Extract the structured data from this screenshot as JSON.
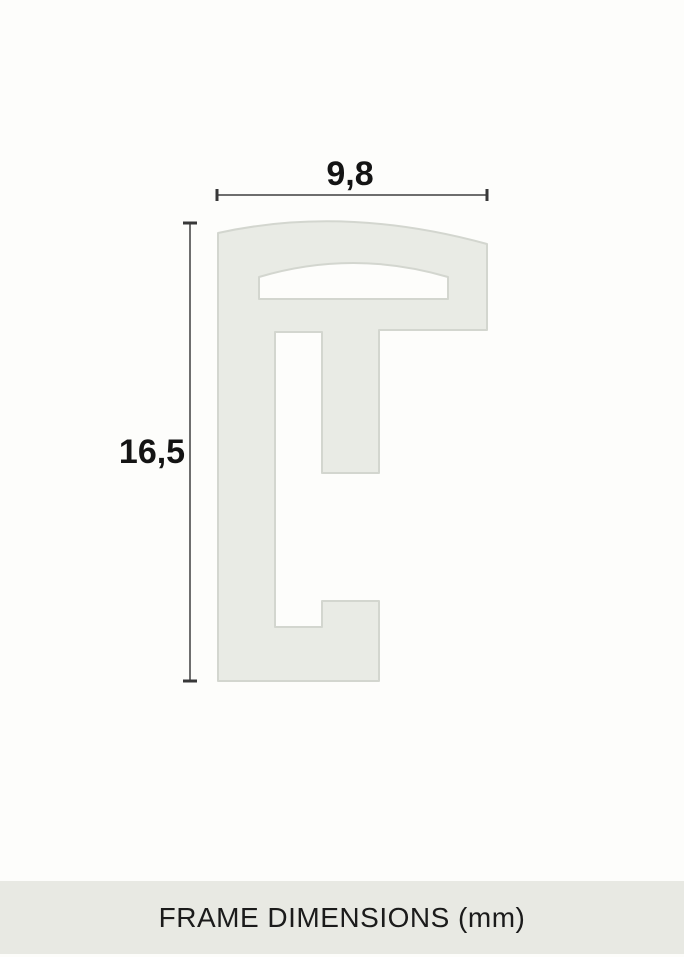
{
  "diagram": {
    "width_label": "9,8",
    "height_label": "16,5",
    "profile": {
      "fill": "#e9ebe5",
      "stroke": "#d3d6cf"
    },
    "dimension_line_color": "#6e6e6e",
    "tick_color": "#383838",
    "label_color": "#141414"
  },
  "footer": {
    "caption": "FRAME DIMENSIONS (mm)",
    "background": "#e8e9e3",
    "text_color": "#1b1b1b"
  }
}
